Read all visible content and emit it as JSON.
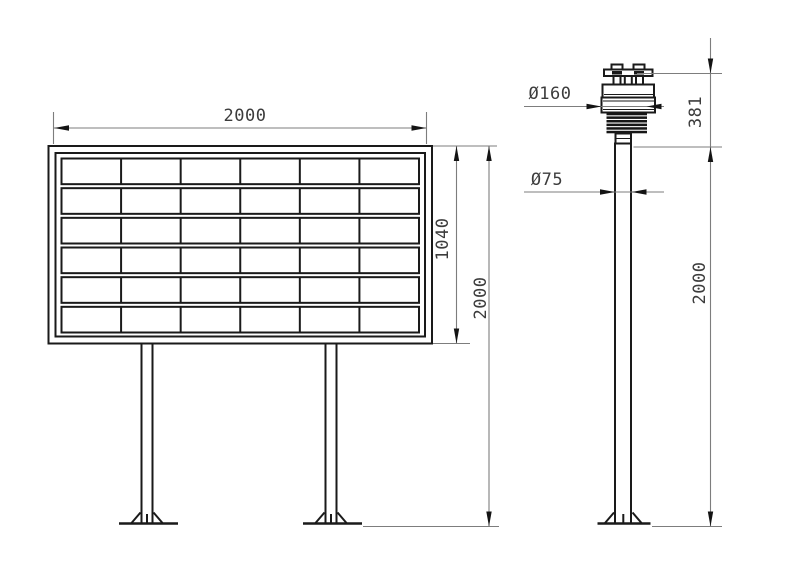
{
  "drawing": {
    "type": "technical-dimension-drawing",
    "left_view": {
      "name": "led-display-board-front-view",
      "width_label": "2000",
      "panel_height_label": "1040",
      "total_height_label": "2000",
      "grid": {
        "rows": 6,
        "cols": 6
      }
    },
    "right_view": {
      "name": "weather-sensor-on-pole-side-view",
      "sensor_diameter_label": "Ø160",
      "pole_diameter_label": "Ø75",
      "sensor_height_label": "381",
      "pole_height_label": "2000",
      "louver_count": 6
    },
    "colors": {
      "background": "#ffffff",
      "object_line": "#1a1a1a",
      "dimension_line": "#7d7d7d",
      "arrow": "#141414",
      "text": "#3c3c3c"
    }
  }
}
